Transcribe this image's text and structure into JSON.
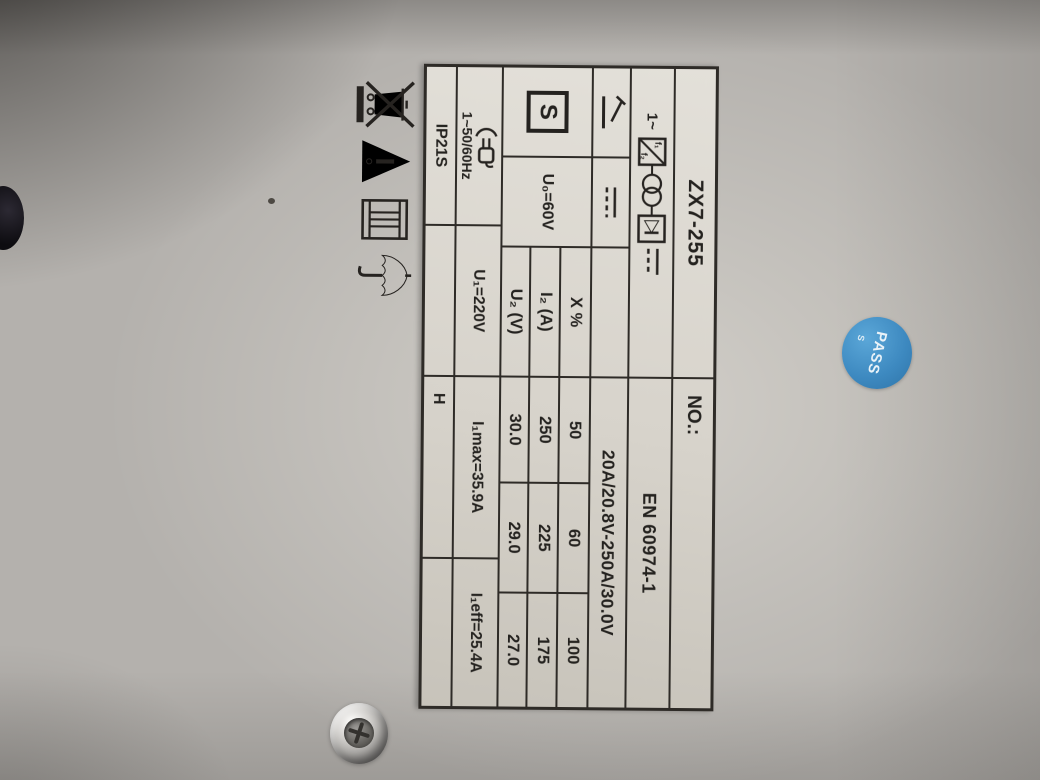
{
  "plate": {
    "model": "ZX7-255",
    "serial_label": "NO.:",
    "standard": "EN 60974-1",
    "output_range": "20A/20.8V-250A/30.0V",
    "s_mark": "S",
    "u0": "U₀=60V",
    "power_symbol": {
      "phase": "1~",
      "f1": "f₁",
      "f2": "f₂"
    },
    "duty_table": {
      "rows": [
        {
          "label": "X %",
          "values": [
            "50",
            "60",
            "100"
          ]
        },
        {
          "label": "I₂ (A)",
          "values": [
            "250",
            "225",
            "175"
          ]
        },
        {
          "label": "U₂ (V)",
          "values": [
            "30.0",
            "29.0",
            "27.0"
          ]
        }
      ]
    },
    "supply": {
      "freq": "1~50/60Hz",
      "voltage": "U₁=220V",
      "i1max": "I₁max=35.9A",
      "i1eff": "I₁eff=25.4A"
    },
    "ip_class": "IP21S",
    "insulation_class": "H"
  },
  "sticker": {
    "text": "PASS",
    "sub": "S",
    "color": "#3d89c0"
  },
  "icons": {
    "process": "mma-electrode-icon",
    "current": "dc-output-icon",
    "power_source": "single-phase-inverter-transformer-rectifier-icon",
    "safety": "s-mark-icon",
    "supply_plug": "mains-plug-icon",
    "weee": "crossed-out-wheelie-bin-icon",
    "warning": "exclamation-triangle-icon",
    "manual": "instruction-book-icon",
    "keep_dry": "umbrella-icon"
  }
}
